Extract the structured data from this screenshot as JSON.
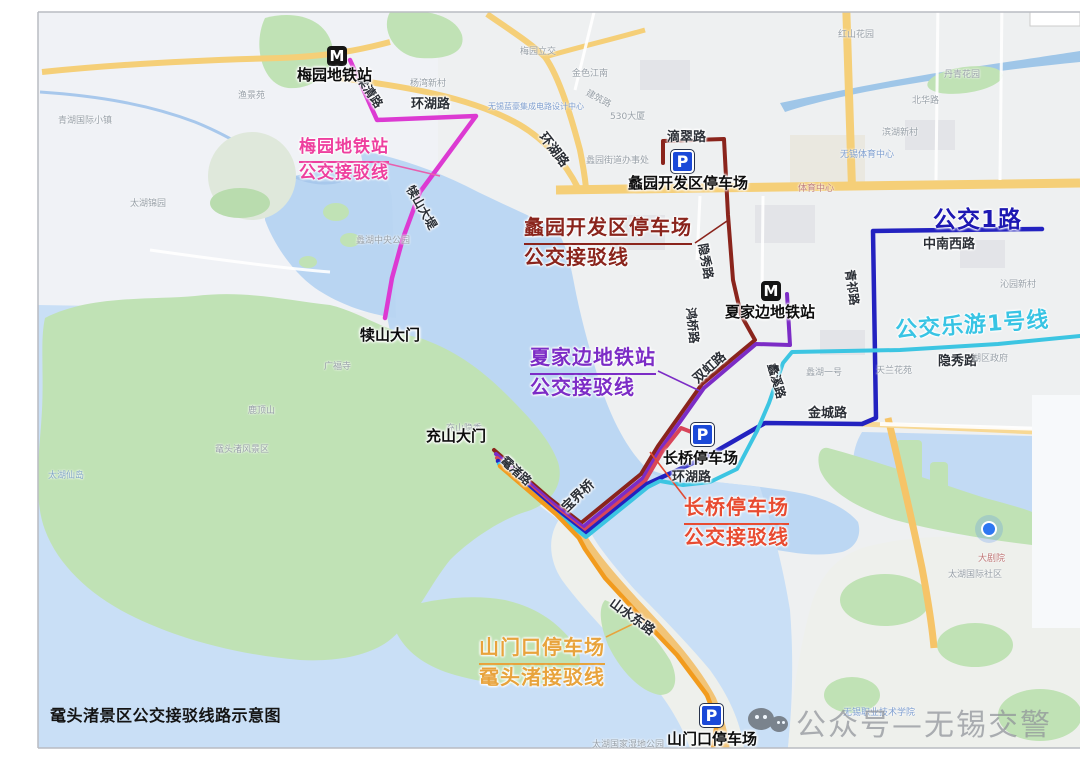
{
  "title": "鼋头渚景区公交接驳线路示意图",
  "watermark": {
    "text": "公众号—无锡交警",
    "icon": "wechat-official-account-icon"
  },
  "banners": [
    {
      "text": "公交1路",
      "color": "#1d18b2",
      "x": 933,
      "y": 200,
      "size": 23,
      "rot": 0
    },
    {
      "text": "公交乐游1号线",
      "color": "#38c4e4",
      "x": 895,
      "y": 307,
      "size": 22,
      "rot": -4
    }
  ],
  "callouts": [
    {
      "line1": "梅园地铁站",
      "line2": "公交接驳线",
      "color": "#ee3f9e",
      "x": 299,
      "y": 137,
      "size": 17
    },
    {
      "line1": "蠡园开发区停车场",
      "line2": "公交接驳线",
      "color": "#8a241c",
      "x": 524,
      "y": 215,
      "size": 20
    },
    {
      "line1": "夏家边地铁站",
      "line2": "公交接驳线",
      "color": "#7c2cc6",
      "x": 530,
      "y": 345,
      "size": 20
    },
    {
      "line1": "长桥停车场",
      "line2": "公交接驳线",
      "color": "#e84b31",
      "x": 684,
      "y": 495,
      "size": 20
    },
    {
      "line1": "山门口停车场",
      "line2": "鼋头渚接驳线",
      "color": "#e8a33c",
      "x": 479,
      "y": 635,
      "size": 20
    }
  ],
  "stations": [
    {
      "label": "梅园地铁站",
      "icon_x": 327,
      "icon_y": 46,
      "label_x": 297,
      "label_y": 64
    },
    {
      "label": "夏家边地铁站",
      "icon_x": 761,
      "icon_y": 281,
      "label_x": 725,
      "label_y": 301
    }
  ],
  "parkings": [
    {
      "label": "蠡园开发区停车场",
      "icon_x": 671,
      "icon_y": 150,
      "label_x": 628,
      "label_y": 172
    },
    {
      "label": "长桥停车场",
      "icon_x": 691,
      "icon_y": 423,
      "label_x": 663,
      "label_y": 447
    },
    {
      "label": "山门口停车场",
      "icon_x": 700,
      "icon_y": 704,
      "label_x": 667,
      "label_y": 728
    }
  ],
  "gates": [
    {
      "label": "犊山大门",
      "x": 360,
      "y": 324
    },
    {
      "label": "充山大门",
      "x": 426,
      "y": 425
    }
  ],
  "road_labels": [
    {
      "t": "环湖路",
      "x": 411,
      "y": 93,
      "r": 0
    },
    {
      "t": "环湖路",
      "x": 543,
      "y": 124,
      "r": 52
    },
    {
      "t": "滴翠路",
      "x": 667,
      "y": 126,
      "r": 0
    },
    {
      "t": "隐秀路",
      "x": 703,
      "y": 235,
      "r": 80,
      "s": 12
    },
    {
      "t": "鸿桥路",
      "x": 691,
      "y": 299,
      "r": 84,
      "s": 12
    },
    {
      "t": "双虹路",
      "x": 694,
      "y": 370,
      "r": -42
    },
    {
      "t": "蠡溪路",
      "x": 772,
      "y": 355,
      "r": 74,
      "s": 12
    },
    {
      "t": "金城路",
      "x": 808,
      "y": 402,
      "r": 0
    },
    {
      "t": "青祁路",
      "x": 850,
      "y": 261,
      "r": 82,
      "s": 12
    },
    {
      "t": "中南西路",
      "x": 923,
      "y": 233,
      "r": 0
    },
    {
      "t": "隐秀路",
      "x": 938,
      "y": 350,
      "r": 0
    },
    {
      "t": "环湖路",
      "x": 672,
      "y": 466,
      "r": 0
    },
    {
      "t": "宝界桥",
      "x": 563,
      "y": 499,
      "r": -44
    },
    {
      "t": "鼋渚路",
      "x": 503,
      "y": 450,
      "r": 42,
      "s": 12
    },
    {
      "t": "山水东路",
      "x": 612,
      "y": 591,
      "r": 36
    },
    {
      "t": "犊山大堤",
      "x": 410,
      "y": 178,
      "r": 60,
      "s": 12
    },
    {
      "t": "梁清路",
      "x": 360,
      "y": 68,
      "r": 56,
      "s": 12
    }
  ],
  "poi_labels": [
    {
      "t": "梅园立交",
      "x": 520,
      "y": 44
    },
    {
      "t": "杨湾新村",
      "x": 410,
      "y": 76
    },
    {
      "t": "金色江南",
      "x": 572,
      "y": 66
    },
    {
      "t": "530大厦",
      "x": 610,
      "y": 109
    },
    {
      "t": "建筑路",
      "x": 587,
      "y": 85,
      "r": 28
    },
    {
      "t": "蠡园街道办事处",
      "x": 586,
      "y": 153
    },
    {
      "t": "无锡蓝豪集成电路设计中心",
      "x": 488,
      "y": 101,
      "c": "#7f9fd0",
      "s": 8
    },
    {
      "t": "红山花园",
      "x": 838,
      "y": 27
    },
    {
      "t": "丹青花园",
      "x": 944,
      "y": 67
    },
    {
      "t": "北华路",
      "x": 912,
      "y": 93
    },
    {
      "t": "滨湖新村",
      "x": 882,
      "y": 125
    },
    {
      "t": "无锡体育中心",
      "x": 840,
      "y": 147,
      "c": "#7f9fd0"
    },
    {
      "t": "体育中心",
      "x": 798,
      "y": 181,
      "c": "#c08080"
    },
    {
      "t": "沁园新村",
      "x": 1000,
      "y": 277
    },
    {
      "t": "湖区政府",
      "x": 972,
      "y": 351
    },
    {
      "t": "蠡湖一号",
      "x": 806,
      "y": 365
    },
    {
      "t": "天兰花苑",
      "x": 876,
      "y": 363
    },
    {
      "t": "蠡湖中央公园",
      "x": 356,
      "y": 233
    },
    {
      "t": "广福寺",
      "x": 324,
      "y": 359
    },
    {
      "t": "鹿顶山",
      "x": 248,
      "y": 403
    },
    {
      "t": "鼋头渚风景区",
      "x": 215,
      "y": 442
    },
    {
      "t": "充山隐秀",
      "x": 446,
      "y": 421
    },
    {
      "t": "太湖仙岛",
      "x": 48,
      "y": 468,
      "c": "#85a8c8"
    },
    {
      "t": "青湖国际小镇",
      "x": 58,
      "y": 113
    },
    {
      "t": "太湖锦园",
      "x": 130,
      "y": 196
    },
    {
      "t": "渔景苑",
      "x": 238,
      "y": 88
    },
    {
      "t": "大剧院",
      "x": 978,
      "y": 551,
      "c": "#c07878"
    },
    {
      "t": "太湖国际社区",
      "x": 948,
      "y": 567
    },
    {
      "t": "无锡职业技术学院",
      "x": 843,
      "y": 705,
      "c": "#7f9fd0"
    },
    {
      "t": "太湖国家湿地公园",
      "x": 592,
      "y": 737
    }
  ],
  "routes": [
    {
      "name": "梅园地铁站公交接驳线",
      "color": "#dc3ad2",
      "w": 4.5,
      "points": [
        [
          350,
          60
        ],
        [
          377,
          120
        ],
        [
          476,
          116
        ],
        [
          420,
          192
        ],
        [
          403,
          238
        ],
        [
          392,
          278
        ],
        [
          385,
          318
        ]
      ]
    },
    {
      "name": "蠡园开发区停车场公交接驳线",
      "color": "#8a241c",
      "w": 4,
      "points": [
        [
          663,
          163
        ],
        [
          663,
          141
        ],
        [
          724,
          139
        ],
        [
          728,
          215
        ],
        [
          733,
          280
        ],
        [
          741,
          315
        ],
        [
          755,
          340
        ],
        [
          702,
          384
        ],
        [
          658,
          446
        ],
        [
          641,
          474
        ],
        [
          581,
          523
        ],
        [
          549,
          498
        ],
        [
          494,
          450
        ]
      ]
    },
    {
      "name": "夏家边地铁站公交接驳线",
      "color": "#7c2cc6",
      "w": 4,
      "points": [
        [
          787,
          294
        ],
        [
          790,
          345
        ],
        [
          756,
          344
        ],
        [
          704,
          388
        ],
        [
          660,
          450
        ],
        [
          643,
          478
        ],
        [
          583,
          527
        ],
        [
          551,
          502
        ],
        [
          496,
          454
        ]
      ]
    },
    {
      "name": "长桥停车场公交接驳线",
      "color": "#d8455a",
      "w": 4,
      "points": [
        [
          694,
          433
        ],
        [
          681,
          428
        ],
        [
          662,
          452
        ],
        [
          645,
          481
        ],
        [
          584,
          531
        ],
        [
          552,
          506
        ],
        [
          497,
          458
        ]
      ]
    },
    {
      "name": "公交1路",
      "color": "#2322c0",
      "w": 4.5,
      "points": [
        [
          1042,
          229
        ],
        [
          873,
          231
        ],
        [
          876,
          418
        ],
        [
          862,
          424
        ],
        [
          765,
          423
        ],
        [
          706,
          457
        ],
        [
          647,
          484
        ],
        [
          585,
          534
        ],
        [
          553,
          509
        ],
        [
          498,
          461
        ]
      ]
    },
    {
      "name": "公交乐游1号线",
      "color": "#3cc5e2",
      "w": 4,
      "points": [
        [
          1080,
          336
        ],
        [
          998,
          344
        ],
        [
          900,
          350
        ],
        [
          792,
          352
        ],
        [
          783,
          363
        ],
        [
          769,
          403
        ],
        [
          757,
          431
        ],
        [
          737,
          469
        ],
        [
          710,
          482
        ],
        [
          683,
          485
        ],
        [
          660,
          481
        ],
        [
          648,
          487
        ],
        [
          586,
          537
        ],
        [
          554,
          512
        ],
        [
          499,
          464
        ]
      ]
    },
    {
      "name": "山门口停车场鼋头渚接驳线",
      "color": "#f29b1d",
      "w": 4.5,
      "points": [
        [
          713,
          748
        ],
        [
          717,
          722
        ],
        [
          707,
          695
        ],
        [
          677,
          655
        ],
        [
          639,
          615
        ],
        [
          605,
          578
        ],
        [
          585,
          549
        ],
        [
          579,
          538
        ],
        [
          556,
          514
        ],
        [
          500,
          466
        ]
      ]
    }
  ],
  "leaders": [
    {
      "x1": 385,
      "y1": 163,
      "x2": 440,
      "y2": 176,
      "color": "#e85fae"
    },
    {
      "x1": 695,
      "y1": 243,
      "x2": 727,
      "y2": 221,
      "color": "#8a241c"
    },
    {
      "x1": 658,
      "y1": 371,
      "x2": 700,
      "y2": 391,
      "color": "#7c2cc6"
    },
    {
      "x1": 650,
      "y1": 452,
      "x2": 686,
      "y2": 499,
      "color": "#e04a33"
    },
    {
      "x1": 637,
      "y1": 622,
      "x2": 606,
      "y2": 637,
      "color": "#e8a33c"
    }
  ]
}
